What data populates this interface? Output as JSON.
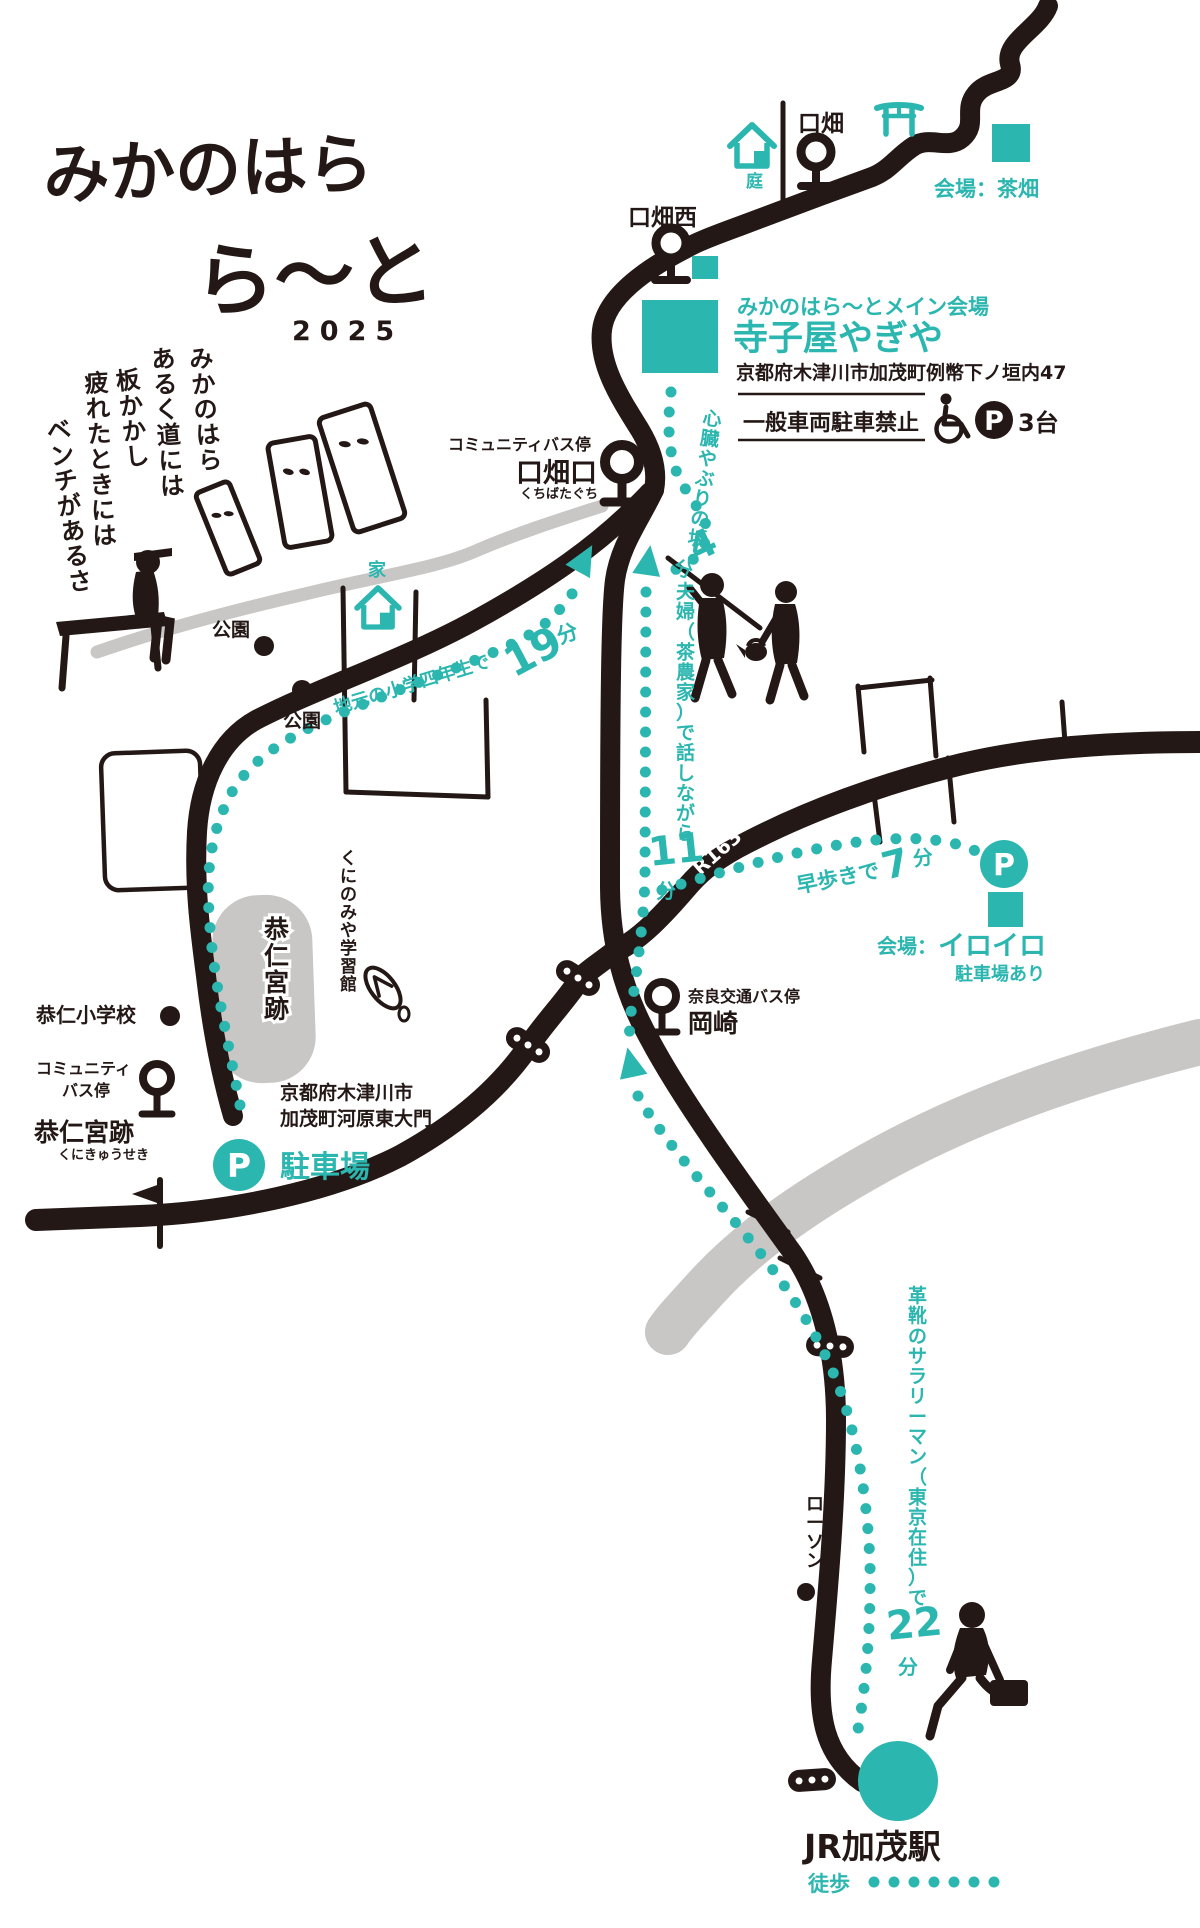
{
  "colors": {
    "teal": "#2cb6b0",
    "ink": "#231815",
    "grey": "#c9c7c5"
  },
  "logo": {
    "line1": "みかのはら",
    "line2": "ら〜と",
    "year": "2025"
  },
  "poem": {
    "cols": [
      "みかのはら",
      "あるく道には",
      "板かかし",
      "疲れたときには",
      "ベンチがあるさ"
    ]
  },
  "venues": {
    "chabatake": {
      "label": "会場：茶畑"
    },
    "main": {
      "tag": "みかのはら〜とメイン会場",
      "name": "寺子屋やぎや",
      "address": "京都府木津川市加茂町例幣下ノ垣内47",
      "no_parking": "一般車両駐車禁止",
      "p": "P",
      "parking_count": "3台"
    },
    "iroiro": {
      "label_prefix": "会場：",
      "name": "イロイロ",
      "parking": "駐車場あり",
      "p": "P"
    }
  },
  "stops": {
    "kuchibata": "口畑",
    "kuchibata_nishi": "口畑西",
    "kuchibataguchi": {
      "type": "コミュニティバス停",
      "name": "口畑口",
      "kana": "くちばたぐち"
    },
    "okazaki": {
      "type": "奈良交通バス停",
      "name": "岡崎"
    },
    "kunikyuseki": {
      "type1": "コミュニティ",
      "type2": "バス停",
      "name": "恭仁宮跡",
      "kana": "くにきゅうせき"
    }
  },
  "places": {
    "niwa": "庭",
    "ie": "家",
    "park1": "公園",
    "park2": "公園",
    "kunimiya": "くにのみや学習館",
    "kunikyu_ruins": "恭仁宮跡",
    "kuni_elementary": "恭仁小学校",
    "parking_addr1": "京都府木津川市",
    "parking_addr2": "加茂町河原東大門",
    "parking": "駐車場",
    "p": "P",
    "lawson": "ローソン",
    "r163": "R163",
    "kamo_station": "JR加茂駅",
    "toho": "徒歩"
  },
  "routes": {
    "r19": {
      "label": "地元の小学四年生で",
      "min": "19",
      "unit": "分"
    },
    "r4": {
      "label": "心臓やぶりの坂",
      "min": "4",
      "unit": "分"
    },
    "r11": {
      "label": "夫婦（茶農家）で話しながら",
      "min": "11",
      "unit": "分"
    },
    "r7": {
      "label": "早歩きで",
      "min": "7",
      "unit": "分"
    },
    "r22": {
      "label": "革靴のサラリーマン（東京在住）で",
      "min": "22",
      "unit": "分"
    }
  }
}
